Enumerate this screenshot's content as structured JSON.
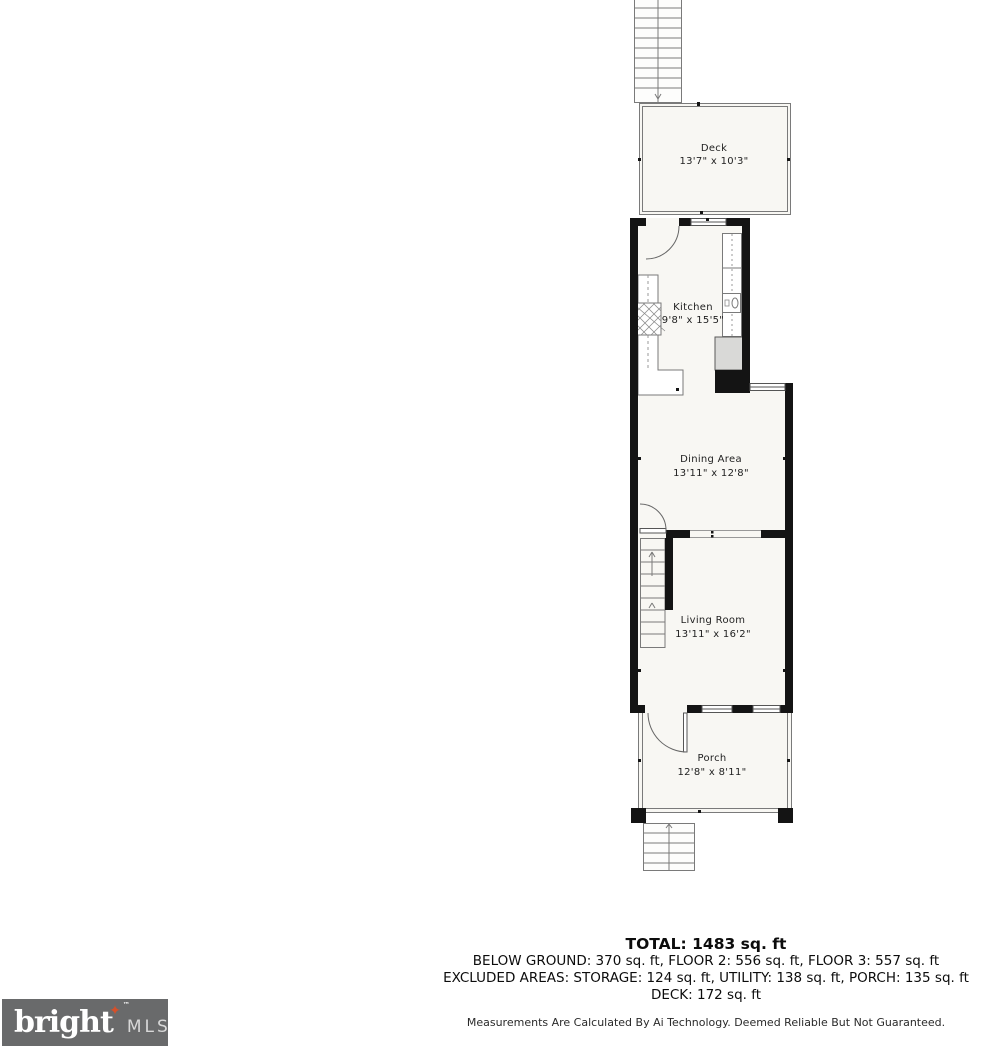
{
  "floor_plan": {
    "rooms": {
      "deck": {
        "label": "Deck",
        "dims": "13'7\" x 10'3\""
      },
      "kitchen": {
        "label": "Kitchen",
        "dims": "9'8\" x 15'5\""
      },
      "dining": {
        "label": "Dining Area",
        "dims": "13'11\" x 12'8\""
      },
      "living": {
        "label": "Living Room",
        "dims": "13'11\" x 16'2\""
      },
      "porch": {
        "label": "Porch",
        "dims": "12'8\" x 8'11\""
      }
    }
  },
  "summary": {
    "total": "TOTAL: 1483 sq. ft",
    "line2": "BELOW GROUND: 370 sq. ft, FLOOR 2: 556 sq. ft, FLOOR 3: 557 sq. ft",
    "line3": "EXCLUDED AREAS: STORAGE: 124 sq. ft, UTILITY: 138 sq. ft, PORCH: 135 sq. ft",
    "line4": "DECK: 172 sq. ft",
    "disclaimer": "Measurements Are Calculated By Ai Technology. Deemed Reliable But Not Guaranteed."
  },
  "logo": {
    "brand": "bright",
    "suffix": "MLS",
    "trademark": "™",
    "star": "✦"
  },
  "colors": {
    "wall": "#141414",
    "room_fill": "#f8f7f3",
    "thin_line": "#7a7a7a",
    "logo_bg": "#696a6b",
    "logo_star": "#d4502a"
  }
}
